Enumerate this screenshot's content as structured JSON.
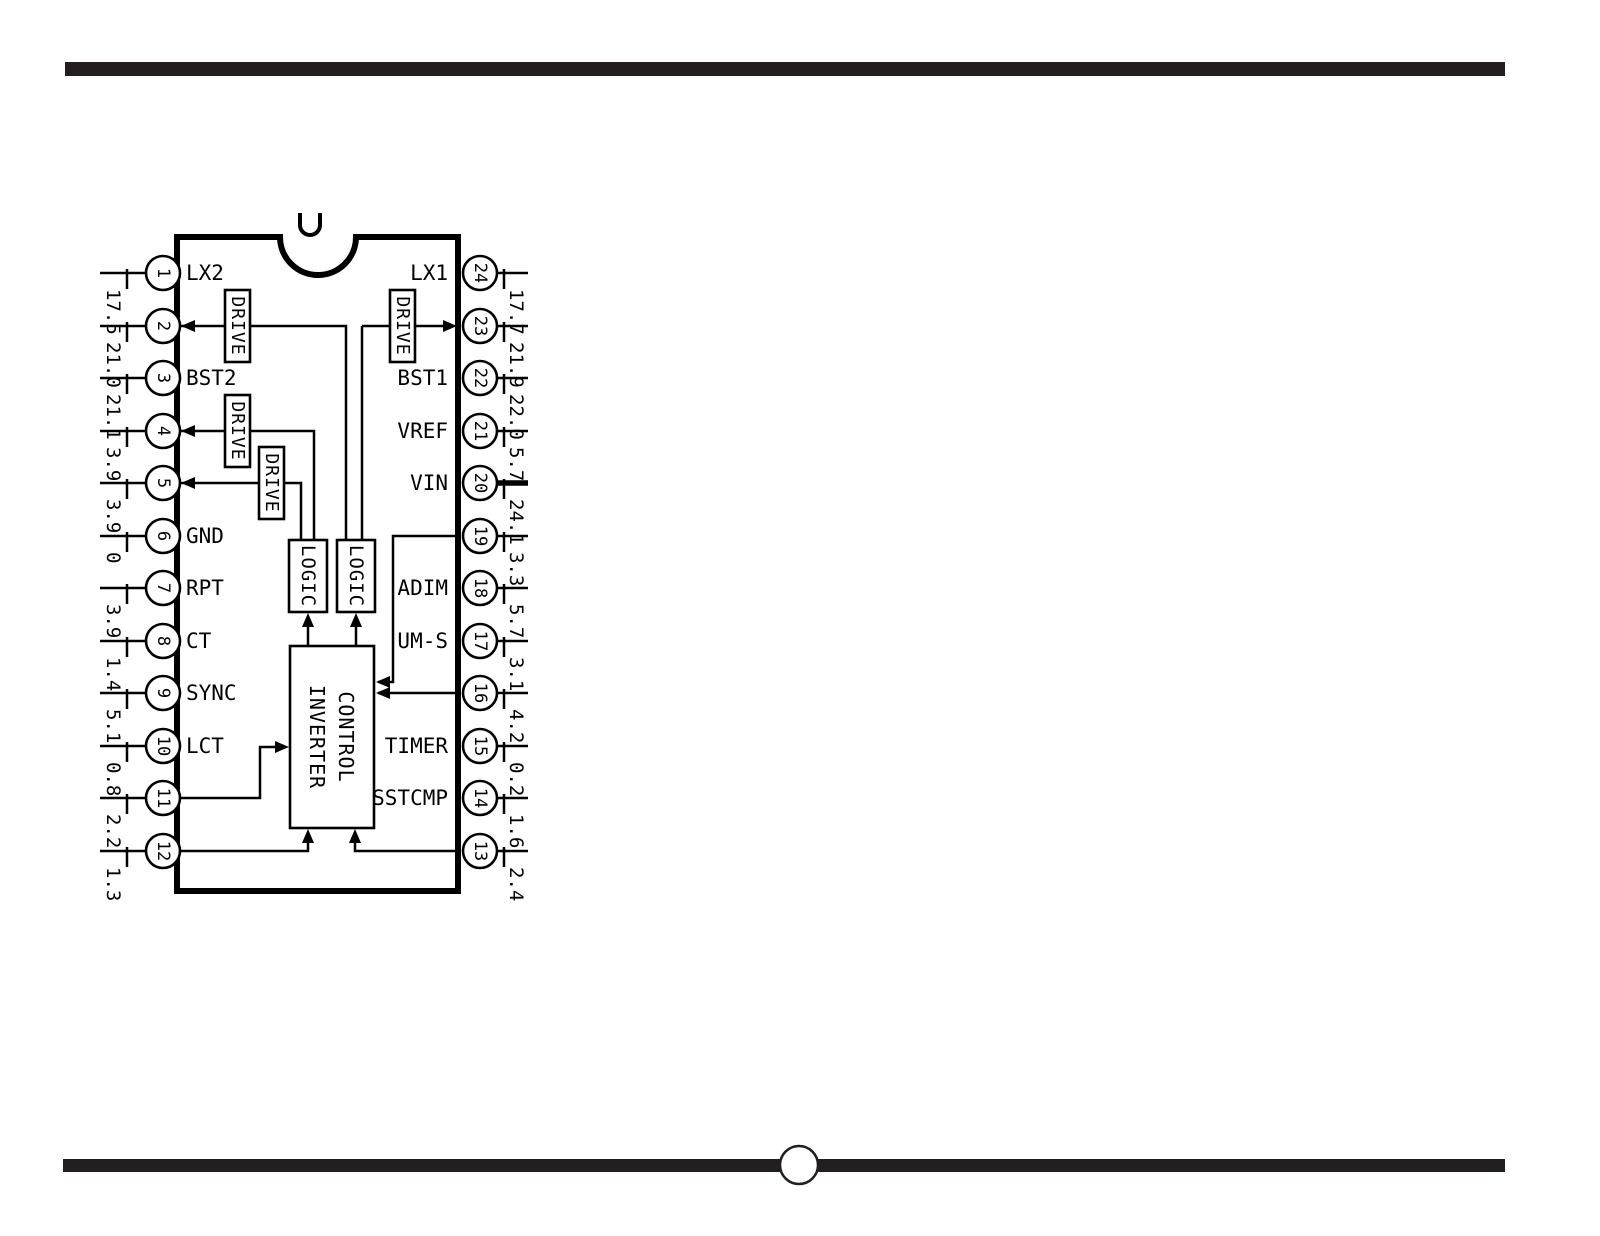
{
  "diagram": {
    "partial_top_glyph": "U",
    "blocks": {
      "drive": "DRIVE",
      "logic": "LOGIC",
      "inverter_control_line1": "INVERTER",
      "inverter_control_line2": "CONTROL"
    },
    "pins_left": [
      {
        "number": "1",
        "label": "LX2",
        "value": "17.5"
      },
      {
        "number": "2",
        "label": "",
        "value": "21.0"
      },
      {
        "number": "3",
        "label": "BST2",
        "value": "21.1"
      },
      {
        "number": "4",
        "label": "",
        "value": "3.9"
      },
      {
        "number": "5",
        "label": "",
        "value": "3.9"
      },
      {
        "number": "6",
        "label": "GND",
        "value": "0"
      },
      {
        "number": "7",
        "label": "RPT",
        "value": "3.9"
      },
      {
        "number": "8",
        "label": "CT",
        "value": "1.4"
      },
      {
        "number": "9",
        "label": "SYNC",
        "value": "5.1"
      },
      {
        "number": "10",
        "label": "LCT",
        "value": "0.8"
      },
      {
        "number": "11",
        "label": "",
        "value": "2.2"
      },
      {
        "number": "12",
        "label": "",
        "value": "1.3"
      }
    ],
    "pins_right": [
      {
        "number": "24",
        "label": "LX1",
        "value": "17.7"
      },
      {
        "number": "23",
        "label": "",
        "value": "21.9"
      },
      {
        "number": "22",
        "label": "BST1",
        "value": "22.0"
      },
      {
        "number": "21",
        "label": "VREF",
        "value": "5.7"
      },
      {
        "number": "20",
        "label": "VIN",
        "value": "24.1"
      },
      {
        "number": "19",
        "label": "",
        "value": "3.3"
      },
      {
        "number": "18",
        "label": "ADIM",
        "value": "5.7"
      },
      {
        "number": "17",
        "label": "UM-S",
        "value": "3.1"
      },
      {
        "number": "16",
        "label": "",
        "value": "4.2"
      },
      {
        "number": "15",
        "label": "TIMER",
        "value": "0.2"
      },
      {
        "number": "14",
        "label": "SSTCMP",
        "value": "1.6"
      },
      {
        "number": "13",
        "label": "",
        "value": "2.4"
      }
    ],
    "colors": {
      "line": "#000000",
      "rule_bar": "#231f20",
      "paper": "#ffffff"
    }
  }
}
